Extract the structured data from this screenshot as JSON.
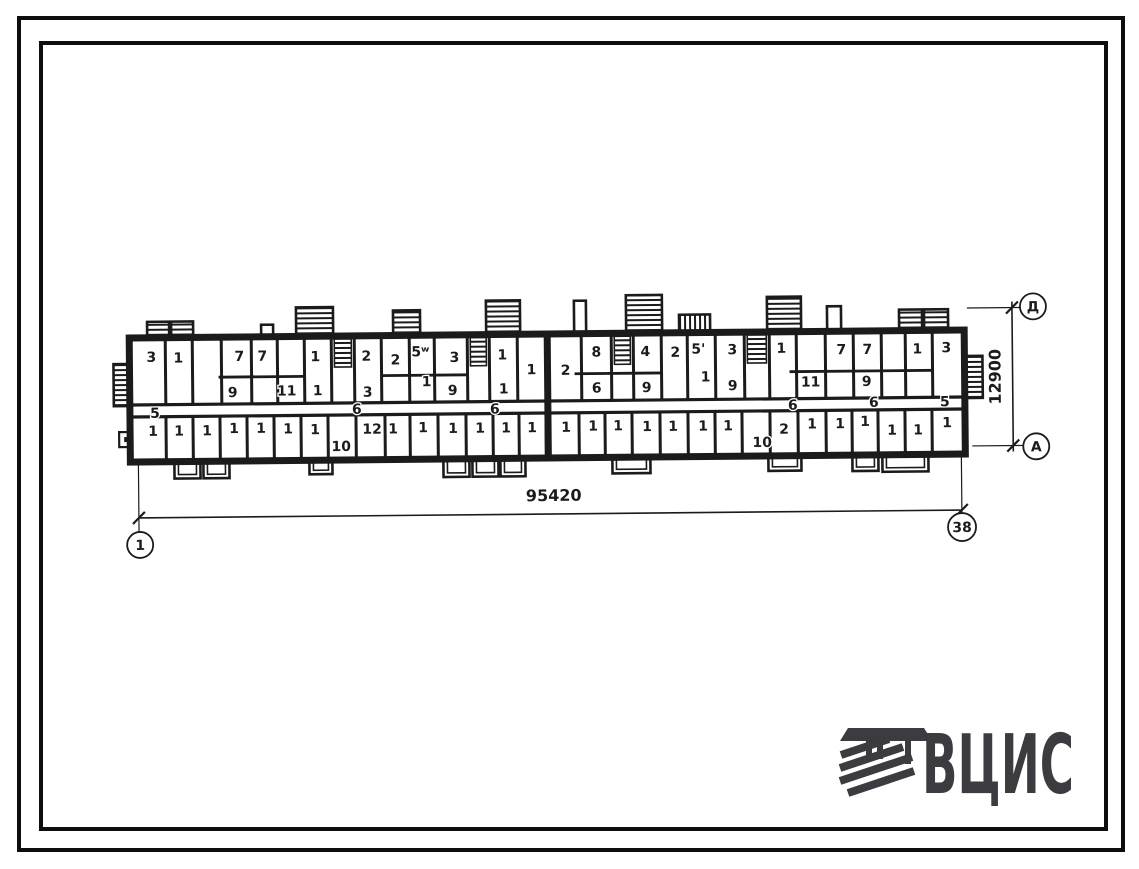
{
  "drawing_title": "typical-floor-plan",
  "colors": {
    "ink": "#1b1b1b",
    "paper": "#ffffff",
    "logo": "#3b3b40"
  },
  "logo": {
    "text": "ВЦИС",
    "icon": "hatched-column-emblem"
  },
  "dimensions": {
    "bottom": {
      "label": "95420",
      "axis_left": "1",
      "axis_right": "38"
    },
    "right": {
      "label": "12900",
      "axis_top": "Д",
      "axis_bottom": "А"
    }
  },
  "plan": {
    "building": {
      "x": 130,
      "y": 334,
      "w": 835,
      "h": 124,
      "wall": 7
    },
    "corridor": {
      "y1": 401,
      "y2": 413
    },
    "mid_wall_x": 548,
    "upper_walls": [
      166,
      193,
      222,
      252,
      278,
      305,
      332,
      355,
      382,
      410,
      435,
      468,
      490,
      518,
      548,
      582,
      612,
      634,
      662,
      688,
      716,
      745,
      770,
      797,
      826,
      854,
      882,
      906,
      933
    ],
    "lower_walls": [
      166,
      193,
      220,
      247,
      274,
      301,
      328,
      356,
      385,
      410,
      438,
      466,
      493,
      519,
      546,
      579,
      605,
      632,
      660,
      688,
      715,
      742,
      770,
      798,
      826,
      852,
      878,
      905,
      932
    ],
    "sub_walls": [
      [
        219,
        305
      ],
      [
        382,
        468
      ],
      [
        575,
        662
      ],
      [
        790,
        933
      ]
    ],
    "stair_cells": [
      [
        332,
        355
      ],
      [
        468,
        490
      ],
      [
        612,
        634
      ],
      [
        745,
        770
      ]
    ],
    "top_bumps": [
      {
        "x": 148,
        "w": 22,
        "y": 318,
        "hatch": "h"
      },
      {
        "x": 172,
        "w": 22,
        "y": 318,
        "hatch": "h"
      },
      {
        "x": 262,
        "w": 12,
        "y": 322
      },
      {
        "x": 297,
        "w": 37,
        "y": 305,
        "hatch": "h"
      },
      {
        "x": 394,
        "w": 27,
        "y": 309,
        "hatch": "h"
      },
      {
        "x": 487,
        "w": 34,
        "y": 300,
        "hatch": "h"
      },
      {
        "x": 575,
        "w": 12,
        "y": 301
      },
      {
        "x": 627,
        "w": 36,
        "y": 296,
        "hatch": "h"
      },
      {
        "x": 680,
        "w": 31,
        "y": 316,
        "hatch": "v"
      },
      {
        "x": 768,
        "w": 34,
        "y": 299,
        "hatch": "h"
      },
      {
        "x": 828,
        "w": 14,
        "y": 309
      },
      {
        "x": 900,
        "w": 23,
        "y": 313,
        "hatch": "h"
      },
      {
        "x": 925,
        "w": 24,
        "y": 313,
        "hatch": "h"
      }
    ],
    "bottom_bumps": [
      {
        "x": 174,
        "w": 26,
        "h": 17
      },
      {
        "x": 203,
        "w": 26,
        "h": 17
      },
      {
        "x": 309,
        "w": 23,
        "h": 14
      },
      {
        "x": 443,
        "w": 26,
        "h": 18
      },
      {
        "x": 472,
        "w": 26,
        "h": 18
      },
      {
        "x": 500,
        "w": 25,
        "h": 18
      },
      {
        "x": 612,
        "w": 38,
        "h": 16
      },
      {
        "x": 768,
        "w": 33,
        "h": 15
      },
      {
        "x": 852,
        "w": 26,
        "h": 16
      },
      {
        "x": 882,
        "w": 46,
        "h": 17
      }
    ],
    "porch_left": {
      "x": 114,
      "y": 360,
      "w": 21,
      "h": 42
    },
    "porch_right": {
      "x": 963,
      "y": 360,
      "w": 20,
      "h": 42
    },
    "entry_box_left": {
      "x": 119,
      "y": 428,
      "w": 15,
      "h": 15
    },
    "room_labels": [
      [
        152,
        353,
        "3"
      ],
      [
        179,
        354,
        "1"
      ],
      [
        240,
        353,
        "7"
      ],
      [
        263,
        353,
        "7"
      ],
      [
        316,
        354,
        "1"
      ],
      [
        367,
        354,
        "2"
      ],
      [
        396,
        358,
        "2"
      ],
      [
        421,
        350,
        "5ʷ"
      ],
      [
        455,
        356,
        "3"
      ],
      [
        503,
        354,
        "1"
      ],
      [
        532,
        369,
        "1"
      ],
      [
        566,
        370,
        "2"
      ],
      [
        597,
        352,
        "8"
      ],
      [
        646,
        352,
        "4"
      ],
      [
        676,
        353,
        "2"
      ],
      [
        699,
        350,
        "5'"
      ],
      [
        733,
        351,
        "3"
      ],
      [
        782,
        350,
        "1"
      ],
      [
        842,
        352,
        "7"
      ],
      [
        868,
        352,
        "7"
      ],
      [
        918,
        352,
        "1"
      ],
      [
        947,
        351,
        "3"
      ],
      [
        233,
        389,
        "9"
      ],
      [
        287,
        388,
        "11"
      ],
      [
        318,
        388,
        "1"
      ],
      [
        368,
        390,
        "3"
      ],
      [
        427,
        380,
        "1"
      ],
      [
        453,
        389,
        "9"
      ],
      [
        504,
        388,
        "1"
      ],
      [
        597,
        388,
        "6"
      ],
      [
        647,
        388,
        "9"
      ],
      [
        706,
        378,
        "1"
      ],
      [
        733,
        387,
        "9"
      ],
      [
        811,
        384,
        "11"
      ],
      [
        867,
        384,
        "9"
      ],
      [
        155,
        409,
        "5"
      ],
      [
        357,
        407,
        "6"
      ],
      [
        495,
        408,
        "6"
      ],
      [
        793,
        407,
        "6"
      ],
      [
        874,
        405,
        "6"
      ],
      [
        945,
        405,
        "5"
      ],
      [
        153,
        427,
        "1"
      ],
      [
        179,
        427,
        "1"
      ],
      [
        207,
        427,
        "1"
      ],
      [
        234,
        425,
        "1"
      ],
      [
        261,
        425,
        "1"
      ],
      [
        288,
        426,
        "1"
      ],
      [
        315,
        427,
        "1"
      ],
      [
        341,
        444,
        "10"
      ],
      [
        372,
        427,
        "12"
      ],
      [
        393,
        427,
        "1"
      ],
      [
        423,
        426,
        "1"
      ],
      [
        453,
        427,
        "1"
      ],
      [
        480,
        427,
        "1"
      ],
      [
        506,
        427,
        "1"
      ],
      [
        532,
        427,
        "1"
      ],
      [
        566,
        427,
        "1"
      ],
      [
        593,
        426,
        "1"
      ],
      [
        618,
        426,
        "1"
      ],
      [
        647,
        427,
        "1"
      ],
      [
        673,
        427,
        "1"
      ],
      [
        703,
        427,
        "1"
      ],
      [
        728,
        427,
        "1"
      ],
      [
        762,
        444,
        "10"
      ],
      [
        784,
        431,
        "2"
      ],
      [
        812,
        426,
        "1"
      ],
      [
        840,
        426,
        "1"
      ],
      [
        865,
        424,
        "1"
      ],
      [
        892,
        433,
        "1"
      ],
      [
        918,
        433,
        "1"
      ],
      [
        947,
        426,
        "1"
      ]
    ]
  },
  "dim_geometry": {
    "bottom": {
      "x1": 138,
      "x2": 961,
      "y": 514,
      "label_x": 553,
      "label_y": 501,
      "c1": {
        "x": 139,
        "y": 541,
        "r": 13
      },
      "c2": {
        "x": 961,
        "y": 531,
        "r": 14
      }
    },
    "right": {
      "x": 1013,
      "y1": 312,
      "y2": 450,
      "label_x": 1001,
      "label_y": 381,
      "ct": {
        "x": 1034,
        "y": 311,
        "r": 13
      },
      "cb": {
        "x": 1036,
        "y": 451,
        "r": 13
      }
    }
  }
}
